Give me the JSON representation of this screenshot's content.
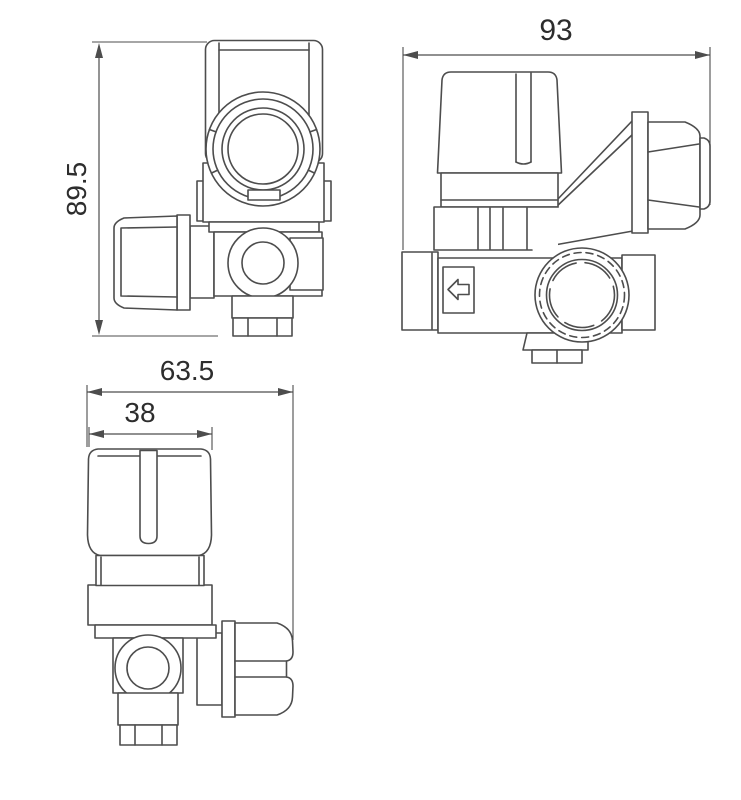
{
  "drawing": {
    "kind": "valve-dimension-drawing",
    "background_color": "#ffffff",
    "line_color": "#4d4d4d",
    "text_color": "#2d2d2d",
    "views": {
      "top_view": {
        "dimension_height": {
          "label": "89.5",
          "orientation": "vertical"
        }
      },
      "side_view": {
        "dimension_width": {
          "label": "93",
          "orientation": "horizontal"
        },
        "flow_arrow": {
          "icon": "arrow-left"
        }
      },
      "front_view": {
        "dimension_overall_width": {
          "label": "63.5",
          "orientation": "horizontal"
        },
        "dimension_knob_width": {
          "label": "38",
          "orientation": "horizontal"
        }
      }
    }
  }
}
